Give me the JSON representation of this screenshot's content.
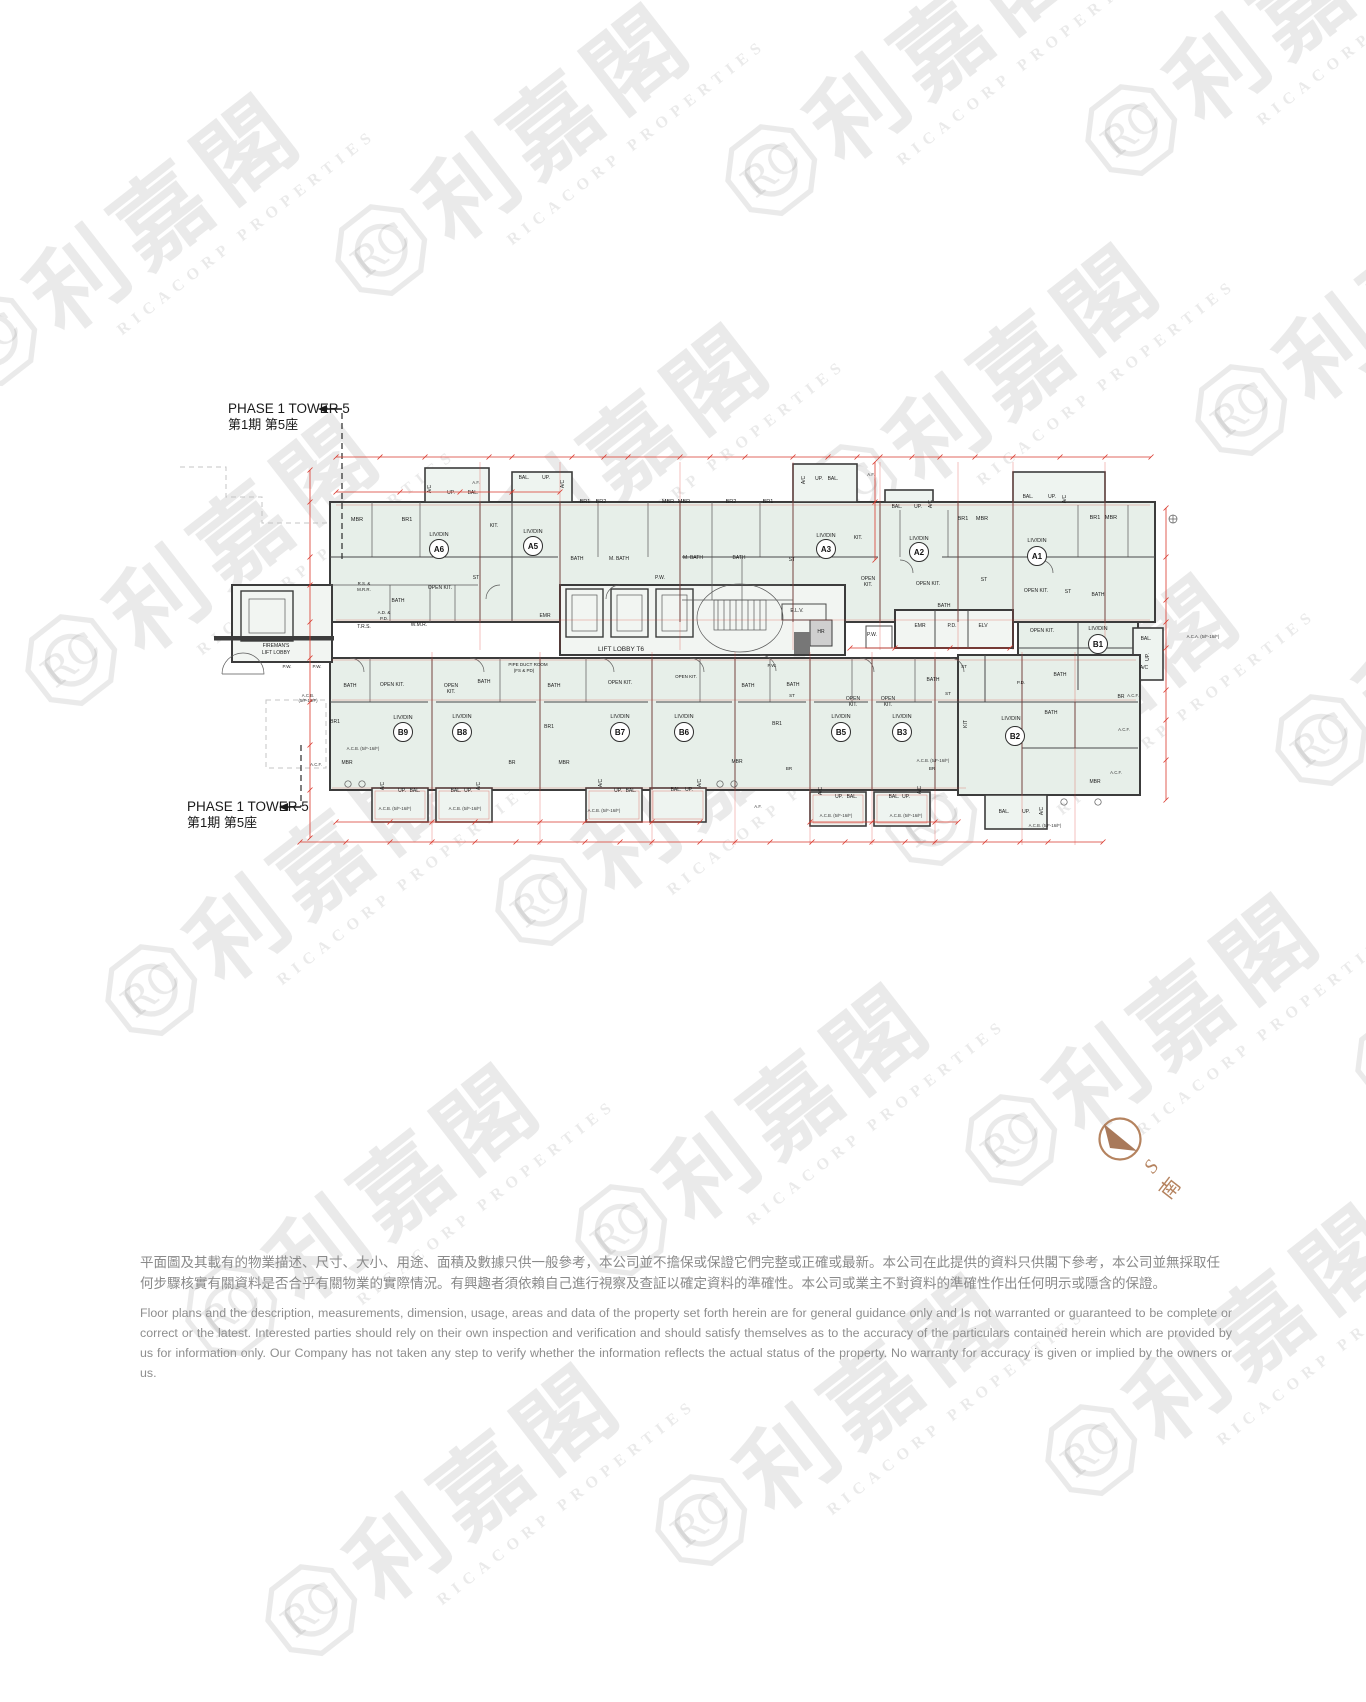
{
  "watermark": {
    "logo_text": "RC",
    "cjk": "利嘉閣",
    "latin": "RICACORP PROPERTIES"
  },
  "phase": {
    "en": "PHASE 1 TOWER 5",
    "zh": "第1期 第5座"
  },
  "compass": {
    "letter": "S",
    "cjk": "南"
  },
  "disclaimer": {
    "zh_line1": "平面圖及其載有的物業描述、尺寸、大小、用途、面積及數據只供一般參考，本公司並不擔保或保證它們完整或正確或最新。本公司在此提供的資料只供閣下參考，本公司並無採取任",
    "zh_line2": "何步驟核實有關資料是否合乎有關物業的實際情況。有興趣者須依賴自己進行視察及查証以確定資料的準確性。本公司或業主不對資料的準確性作出任何明示或隱含的保證。",
    "en": "Floor plans and the description, measurements, dimension, usage, areas and data of the property set forth herein are for general guidance only and Is not warranted or guaranteed to be complete or correct or the latest. Interested parties should rely on their own inspection and verification and should satisfy themselves as to the accuracy of the particulars contained herein which are provided by us for information only.  Our Company has not taken any step to verify whether the information reflects the actual status of the property.  No warranty for accuracy is given or implied by the owners or us."
  },
  "plan": {
    "lift_lobby_label": "LIFT LOBBY T6",
    "units": [
      {
        "id": "A6",
        "x": 439,
        "y": 549
      },
      {
        "id": "A5",
        "x": 533,
        "y": 546
      },
      {
        "id": "A3",
        "x": 826,
        "y": 549
      },
      {
        "id": "A2",
        "x": 919,
        "y": 552
      },
      {
        "id": "A1",
        "x": 1037,
        "y": 556
      },
      {
        "id": "B1",
        "x": 1098,
        "y": 644
      },
      {
        "id": "B9",
        "x": 403,
        "y": 732
      },
      {
        "id": "B8",
        "x": 462,
        "y": 732
      },
      {
        "id": "B7",
        "x": 620,
        "y": 732
      },
      {
        "id": "B6",
        "x": 684,
        "y": 732
      },
      {
        "id": "B5",
        "x": 841,
        "y": 732
      },
      {
        "id": "B3",
        "x": 902,
        "y": 732
      },
      {
        "id": "B2",
        "x": 1015,
        "y": 736
      }
    ],
    "labels": [
      [
        "MBR",
        357,
        521,
        5.5
      ],
      [
        "BR1",
        407,
        521,
        5.5
      ],
      [
        "LIV/DIN",
        439,
        536,
        5.5
      ],
      [
        "KIT.",
        494,
        527,
        5
      ],
      [
        "A/C",
        431,
        489,
        5,
        1
      ],
      [
        "UP.",
        451,
        494,
        5
      ],
      [
        "BAL.",
        473,
        494,
        5
      ],
      [
        "BAL.",
        524,
        479,
        5
      ],
      [
        "UP.",
        546,
        479,
        5
      ],
      [
        "A/C",
        564,
        484,
        5,
        1
      ],
      [
        "LIV/DIN",
        533,
        533,
        5.5
      ],
      [
        "BR1",
        585,
        503,
        5.5
      ],
      [
        "BR2",
        601,
        503,
        5.5
      ],
      [
        "MBR",
        668,
        503,
        5.5
      ],
      [
        "MBR",
        684,
        503,
        5.5
      ],
      [
        "BR2",
        731,
        503,
        5.5
      ],
      [
        "BR1",
        768,
        503,
        5.5
      ],
      [
        "BATH",
        577,
        560,
        5
      ],
      [
        "M. BATH",
        619,
        560,
        5
      ],
      [
        "BATH",
        398,
        602,
        5
      ],
      [
        "OPEN KIT.",
        440,
        589,
        5
      ],
      [
        "ST",
        476,
        579,
        5
      ],
      [
        "R.S. &",
        364,
        585,
        4.4
      ],
      [
        "M.R.R.",
        364,
        591,
        4.4
      ],
      [
        "A.D. &",
        384,
        614,
        4.4
      ],
      [
        "P.D.",
        384,
        620,
        4.4
      ],
      [
        "T.R.S.",
        364,
        628,
        5
      ],
      [
        "W.M.R.",
        419,
        626,
        5
      ],
      [
        "EMR",
        545,
        617,
        5
      ],
      [
        "A/C",
        805,
        480,
        5,
        1
      ],
      [
        "UP.",
        819,
        480,
        5
      ],
      [
        "BAL.",
        833,
        480,
        5
      ],
      [
        "M. BATH",
        693,
        559,
        5
      ],
      [
        "BATH",
        739,
        559,
        5
      ],
      [
        "ST",
        792,
        561,
        5
      ],
      [
        "LIV/DIN",
        826,
        537,
        5.5
      ],
      [
        "KIT.",
        858,
        539,
        5
      ],
      [
        "OPEN",
        868,
        580,
        5
      ],
      [
        "KIT.",
        868,
        586,
        5
      ],
      [
        "E.L.V.",
        797,
        612,
        5
      ],
      [
        "HR",
        821,
        633,
        5
      ],
      [
        "P.W.",
        660,
        579,
        5
      ],
      [
        "P.W.",
        872,
        636,
        5
      ],
      [
        "BAL.",
        897,
        508,
        5
      ],
      [
        "UP.",
        918,
        508,
        5
      ],
      [
        "A/C",
        932,
        504,
        5,
        1
      ],
      [
        "LIV/DIN",
        919,
        540,
        5.5
      ],
      [
        "BR1",
        963,
        520,
        5.5
      ],
      [
        "MBR",
        982,
        520,
        5.5
      ],
      [
        "ST",
        984,
        581,
        5
      ],
      [
        "BATH",
        944,
        607,
        5
      ],
      [
        "OPEN KIT.",
        928,
        585,
        5
      ],
      [
        "EMR",
        920,
        627,
        5
      ],
      [
        "P.D.",
        952,
        627,
        5
      ],
      [
        "ELV",
        983,
        627,
        5
      ],
      [
        "BAL.",
        1028,
        498,
        5
      ],
      [
        "UP.",
        1052,
        498,
        5
      ],
      [
        "A/C",
        1066,
        499,
        5,
        1
      ],
      [
        "LIV/DIN",
        1037,
        542,
        5.5
      ],
      [
        "BR1",
        1095,
        519,
        5.5
      ],
      [
        "MBR",
        1111,
        519,
        5.5
      ],
      [
        "OPEN KIT.",
        1036,
        592,
        5
      ],
      [
        "ST",
        1068,
        593,
        5
      ],
      [
        "BATH",
        1098,
        596,
        5
      ],
      [
        "OPEN KIT.",
        1042,
        632,
        5
      ],
      [
        "LIV/DIN",
        1098,
        630,
        5.5
      ],
      [
        "BAL.",
        1146,
        640,
        5
      ],
      [
        "UP.",
        1149,
        657,
        5,
        1
      ],
      [
        "A/C",
        1144,
        669,
        5
      ],
      [
        "BATH",
        1060,
        676,
        5
      ],
      [
        "P.D.",
        1021,
        684,
        4.5
      ],
      [
        "BR",
        1121,
        698,
        5
      ],
      [
        "ST",
        964,
        668,
        4.5
      ],
      [
        "KIT",
        967,
        724,
        5,
        1
      ],
      [
        "LIV/DIN",
        1011,
        720,
        5.5
      ],
      [
        "BATH",
        1051,
        714,
        5
      ],
      [
        "MBR",
        1095,
        783,
        5
      ],
      [
        "BAL.",
        1004,
        813,
        5
      ],
      [
        "UP.",
        1026,
        813,
        5
      ],
      [
        "A/C",
        1043,
        811,
        5,
        1
      ],
      [
        "FIREMAN'S",
        276,
        647,
        5
      ],
      [
        "LIFT LOBBY",
        276,
        654,
        5
      ],
      [
        "P.W.",
        287,
        668,
        4.5
      ],
      [
        "P.W.",
        317,
        668,
        4.5
      ],
      [
        "BATH",
        350,
        687,
        5
      ],
      [
        "OPEN KIT.",
        392,
        686,
        5
      ],
      [
        "BR1",
        335,
        723,
        5
      ],
      [
        "LIV/DIN",
        403,
        719,
        5.5
      ],
      [
        "MBR",
        347,
        764,
        5
      ],
      [
        "A/C",
        384,
        786,
        5,
        1
      ],
      [
        "UP.",
        402,
        792,
        5
      ],
      [
        "BAL.",
        415,
        792,
        5
      ],
      [
        "OPEN",
        451,
        687,
        5
      ],
      [
        "KIT.",
        451,
        693,
        5
      ],
      [
        "BATH",
        484,
        683,
        5
      ],
      [
        "LIV/DIN",
        462,
        718,
        5.5
      ],
      [
        "BR",
        512,
        764,
        5
      ],
      [
        "A/C",
        480,
        786,
        5,
        1
      ],
      [
        "BAL.",
        456,
        792,
        5
      ],
      [
        "UP.",
        468,
        792,
        5
      ],
      [
        "PIPE DUCT ROOM",
        528,
        666,
        4.5
      ],
      [
        "(FS & PD)",
        524,
        672,
        4.5
      ],
      [
        "BATH",
        554,
        687,
        5
      ],
      [
        "OPEN KIT.",
        620,
        684,
        5
      ],
      [
        "BR1",
        549,
        728,
        5
      ],
      [
        "LIV/DIN",
        620,
        718,
        5.5
      ],
      [
        "MBR",
        564,
        764,
        5
      ],
      [
        "A/C",
        602,
        783,
        5,
        1
      ],
      [
        "UP.",
        618,
        792,
        5
      ],
      [
        "BAL.",
        631,
        792,
        5
      ],
      [
        "OPEN KIT.",
        686,
        678,
        4.5
      ],
      [
        "LIV/DIN",
        684,
        718,
        5.5
      ],
      [
        "BATH",
        748,
        687,
        5
      ],
      [
        "MBR",
        737,
        763,
        5
      ],
      [
        "BAL.",
        676,
        791,
        5
      ],
      [
        "UP.",
        689,
        791,
        5
      ],
      [
        "A/C",
        701,
        783,
        5,
        1
      ],
      [
        "P.W.",
        772,
        667,
        4.5
      ],
      [
        "BATH",
        793,
        686,
        5
      ],
      [
        "ST",
        792,
        697,
        4.5
      ],
      [
        "BR1",
        777,
        725,
        5
      ],
      [
        "BR",
        789,
        770,
        4.5
      ],
      [
        "OPEN",
        853,
        700,
        5
      ],
      [
        "KIT.",
        853,
        706,
        5
      ],
      [
        "LIV/DIN",
        841,
        718,
        5.5
      ],
      [
        "A/C",
        822,
        791,
        5,
        1
      ],
      [
        "UP.",
        839,
        798,
        5
      ],
      [
        "BAL.",
        852,
        798,
        5
      ],
      [
        "OPEN",
        888,
        700,
        5
      ],
      [
        "KIT.",
        888,
        706,
        5
      ],
      [
        "LIV/DIN",
        902,
        718,
        5.5
      ],
      [
        "BATH",
        933,
        681,
        5
      ],
      [
        "ST",
        948,
        695,
        4.5
      ],
      [
        "BR",
        932,
        770,
        4.5
      ],
      [
        "BAL.",
        894,
        798,
        5
      ],
      [
        "UP.",
        906,
        798,
        5
      ],
      [
        "A/C",
        921,
        790,
        5,
        1
      ]
    ],
    "annotations": [
      [
        "A.C.B.",
        308,
        697
      ],
      [
        "(5/F-16/F)",
        308,
        702
      ],
      [
        "A.C.B. (5/F-16/F)",
        363,
        750
      ],
      [
        "A.C.B. (5/F-16/F)",
        395,
        810
      ],
      [
        "A.C.B. (5/F-16/F)",
        465,
        810
      ],
      [
        "A.C.B. (5/F-16/F)",
        604,
        812
      ],
      [
        "A.C.B. (5/F-16/F)",
        836,
        817
      ],
      [
        "A.C.B. (5/F-16/F)",
        906,
        817
      ],
      [
        "A.C.B. (5/F-16/F)",
        933,
        762
      ],
      [
        "A.C.B. (5/F-16/F)",
        1045,
        827
      ],
      [
        "A.C.A. (5/F-16/F)",
        1203,
        638
      ],
      [
        "A.C.F.",
        316,
        766
      ],
      [
        "A.C.F.",
        1133,
        697
      ],
      [
        "A.C.F.",
        1124,
        731
      ],
      [
        "A.C.F.",
        1116,
        774
      ],
      [
        "A.F.",
        476,
        484
      ],
      [
        "A.F.",
        871,
        476
      ],
      [
        "A.F.",
        758,
        808
      ]
    ]
  }
}
